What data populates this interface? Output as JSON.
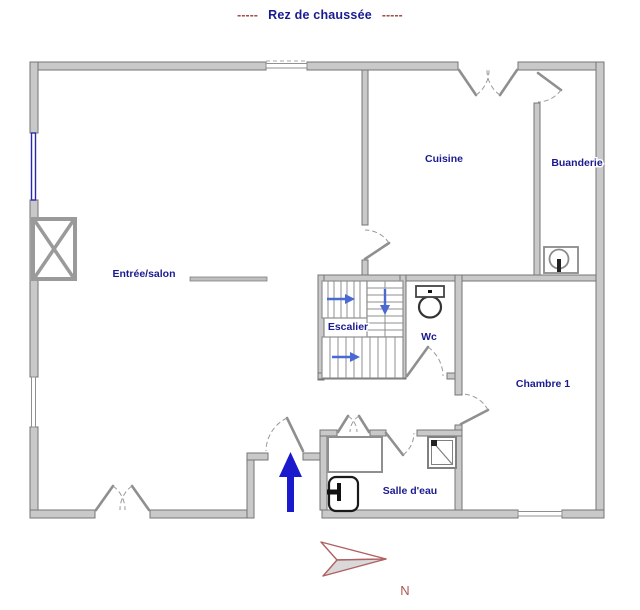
{
  "title": {
    "left_dashes": "-----",
    "text": "Rez de chaussée",
    "right_dashes": "-----"
  },
  "rooms": {
    "entree_salon": {
      "label": "Entrée/salon"
    },
    "cuisine": {
      "label": "Cuisine"
    },
    "buanderie": {
      "label": "Buanderie"
    },
    "escalier": {
      "label": "Escalier"
    },
    "wc": {
      "label": "Wc"
    },
    "chambre1": {
      "label": "Chambre 1"
    },
    "salle_deau": {
      "label": "Salle d'eau"
    }
  },
  "compass": {
    "label": "N"
  },
  "fixtures": {
    "fireplace": "fireplace-icon",
    "washing_machine": "washing-machine-icon",
    "toilet": "toilet-icon",
    "shower": "shower-icon",
    "sink": "sink-icon",
    "closet": "closet-icon",
    "stairs": "staircase",
    "entry_arrow": "entry-arrow-icon",
    "north_arrow": "north-arrow-icon"
  },
  "colors": {
    "room_label": "#1b1b8f",
    "title_text": "#1b1b8f",
    "title_dashes": "#a04040",
    "wall_fill": "#c9c9c9",
    "wall_stroke": "#757575",
    "window_accent": "#2a2aa8",
    "entry_arrow": "#1a1acc",
    "stair_arrow": "#4a69d2",
    "compass": "#b05555"
  }
}
